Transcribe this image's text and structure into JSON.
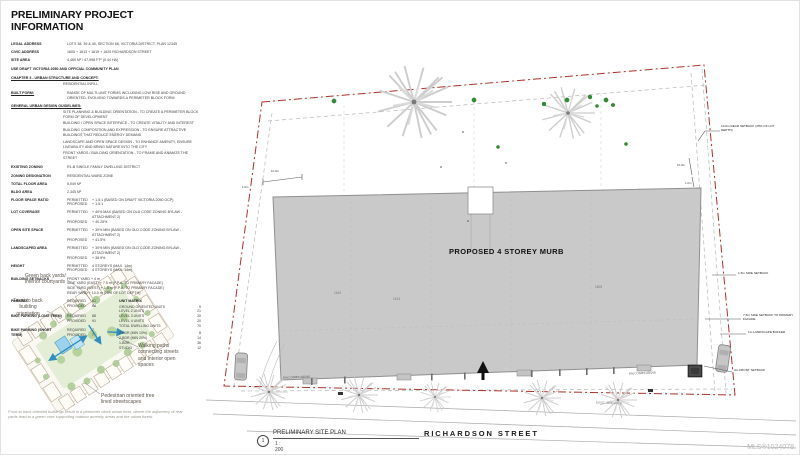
{
  "watermark": "MLS®1024078",
  "info": {
    "title": "PRELIMINARY PROJECT INFORMATION",
    "fields": [
      {
        "label": "LEGAL ADDRESS",
        "value": "LOTS 38, 39 & 40, SECTION 68, VICTORIA DISTRICT, PLAN 12345"
      },
      {
        "label": "CIVIC ADDRESS",
        "value": "1605 + 1613 + 1619 + 1625 RICHARDSON STREET"
      },
      {
        "label": "SITE AREA",
        "value": "4,460 M² / 47,998 FT² (0.44 HA)"
      }
    ],
    "ocp_line": "USE DRAFT VICTORIA 2050 AND OFFICIAL COMMUNITY PLAN",
    "chapter_heading": "CHAPTER 3 - URBAN STRUCTURE AND CONCEPT:",
    "chapter_value": "RESIDENTIAL INFILL",
    "built_form_label": "BUILT FORM:",
    "built_form_value": "RANGE OF MULTI-UNIT FORMS INCLUDING LOW RISE AND GROUND ORIENTED, EVOLVING TOWARDS A PERIMETER BLOCK FORM",
    "guidelines_heading": "GENERAL URBAN DESIGN GUIDELINES:",
    "guidelines": [
      "SITE PLANNING & BUILDING ORIENTATION - TO CREATE A PERIMETER BLOCK FORM OF DEVELOPMENT",
      "BUILDING / OPEN SPACE INTERFACE - TO CREATE VITALITY AND INTEREST",
      "BUILDING COMPOSITION AND EXPRESSION - TO ENSURE ATTRACTIVE BUILDINGS THAT REDUCE ENERGY DEMAND",
      "LANDSCAPE AND OPEN SPACE DESIGN - TO ENHANCE AMENITY, ENSURE LIVEABILITY AND BRING NATURE INTO THE CITY",
      "FRONT YARDS / BUILDING ORIENTATION - TO FRAME AND ANIMATE THE STREET"
    ],
    "facts": [
      {
        "label": "EXISTING ZONING",
        "value": "R1-B SINGLE FAMILY DWELLING DISTRICT"
      },
      {
        "label": "ZONING DESIGNATION",
        "value": "RESIDENTIAL WARD ZONE"
      },
      {
        "label": "TOTAL FLOOR AREA",
        "value": "5,049 M²"
      },
      {
        "label": "BLDG AREA",
        "value": "2,345 M²"
      }
    ],
    "permitted_label": "PERMITTED",
    "proposed_label": "PROPOSED",
    "required_label": "REQUIRED",
    "provided_label": "PROVIDED",
    "ratios": [
      {
        "label": "FLOOR SPACE RATIO",
        "permitted": "+ 1.5:1 (BASED ON DRAFT VICTORIA 2050 OCP)",
        "proposed": "+ 1.5:1"
      },
      {
        "label": "LOT COVERAGE",
        "permitted": "+ 40% MAX (BASED ON OLD CODE ZONING BYLAW - ATTACHMENT 2)",
        "proposed": "+ 40.25%"
      },
      {
        "label": "OPEN SITE SPACE",
        "permitted": "+ 30% MIN (BASED ON OLD CODE ZONING BYLAW - ATTACHMENT 2)",
        "proposed": "+ 41.5%"
      },
      {
        "label": "LANDSCAPED AREA",
        "permitted": "+ 30% MIN (BASED ON OLD CODE ZONING BYLAW - ATTACHMENT 2)",
        "proposed": "+ 38.9%"
      },
      {
        "label": "HEIGHT",
        "permitted": "4 STOREYS (MAX. 14m)",
        "proposed": "4 STOREYS (MAX. 14m)"
      }
    ],
    "setbacks": {
      "label": "BUILDING SETBACKS",
      "lines": [
        "FRONT YARD + 4 m",
        "SIDE YARD (EAST) + 7.5 m (F.P.A. TO PRIMARY FACADE)",
        "SIDE YARD (WEST) + 1.5 m (F.P.A. TO PRIMARY FACADE)",
        "REAR YARD + 10.0 m (25% OF LOT DEPTH)"
      ]
    },
    "parking": {
      "label": "PARKING",
      "required": "61",
      "provided": "64"
    },
    "bike_long": {
      "label": "BIKE PARKING (LONG TERM)",
      "required": "88",
      "provided": "91"
    },
    "bike_short": {
      "label": "BIKE PARKING (SHORT TERM)",
      "required": "7",
      "provided": "7"
    },
    "unit_matrix": {
      "heading": "UNIT MATRIX",
      "rows": [
        {
          "name": "GROUND ORIENTED UNITS",
          "count": "9"
        },
        {
          "name": "LEVEL 2 UNITS",
          "count": "21"
        },
        {
          "name": "LEVEL 3 UNITS",
          "count": "20"
        },
        {
          "name": "LEVEL 4 UNITS",
          "count": "20"
        },
        {
          "name": "TOTAL DWELLING UNITS",
          "count": "70"
        },
        {
          "name": "2-BDR (MIN 10%)",
          "count": "8"
        },
        {
          "name": "2-BDR (MIN 20%)",
          "count": "14"
        },
        {
          "name": "1-BDR",
          "count": "36"
        },
        {
          "name": "STUDIO",
          "count": "12"
        }
      ]
    }
  },
  "diagram": {
    "labels": {
      "courtyards": "Green back yards/ interior courtyards",
      "orientation": "Front to back building orientation",
      "walking": "Walking paths connecting streets and interior open spaces",
      "pedestrian": "Pedestrian oriented tree lined streetscapes"
    },
    "caption": "Front to back oriented buildings result in a perimeter block urban form, where the adjacency of rear yards lead to a green core supporting outdoor amenity areas and the urban forest."
  },
  "plan": {
    "building_label": "PROPOSED 4 STOREY MURB",
    "street": "RICHARDSON STREET",
    "lot_numbers": [
      "1619",
      "1613",
      "1605"
    ],
    "titleblock": {
      "number": "1",
      "title": "PRELIMINARY SITE PLAN",
      "scale": "1 : 200"
    },
    "notes": {
      "rear_setback": "10.0m REAR SETBACK (25% OF LOT DEPTH)",
      "side_setback": "1.5m SIDE SETBACK",
      "side_setback_primary": "7.5m SIDE SETBACK TO PRIMARY FACADE",
      "landscape_buffer": "1m LANDSCAPE BUFFER",
      "front_setback": "4m FRONT SETBACK",
      "balconies": "BALCONIES ABOVE",
      "sidewalk": "EXIST. SIDEWALK",
      "dim_a": "10.0m",
      "dim_b": "1.5m",
      "dim_c": "10.0m",
      "dim_d": "1.0m"
    },
    "colors": {
      "property_line": "#b03028",
      "building_fill": "#c9c9c9",
      "shrub_green": "#2f8f2f"
    }
  }
}
